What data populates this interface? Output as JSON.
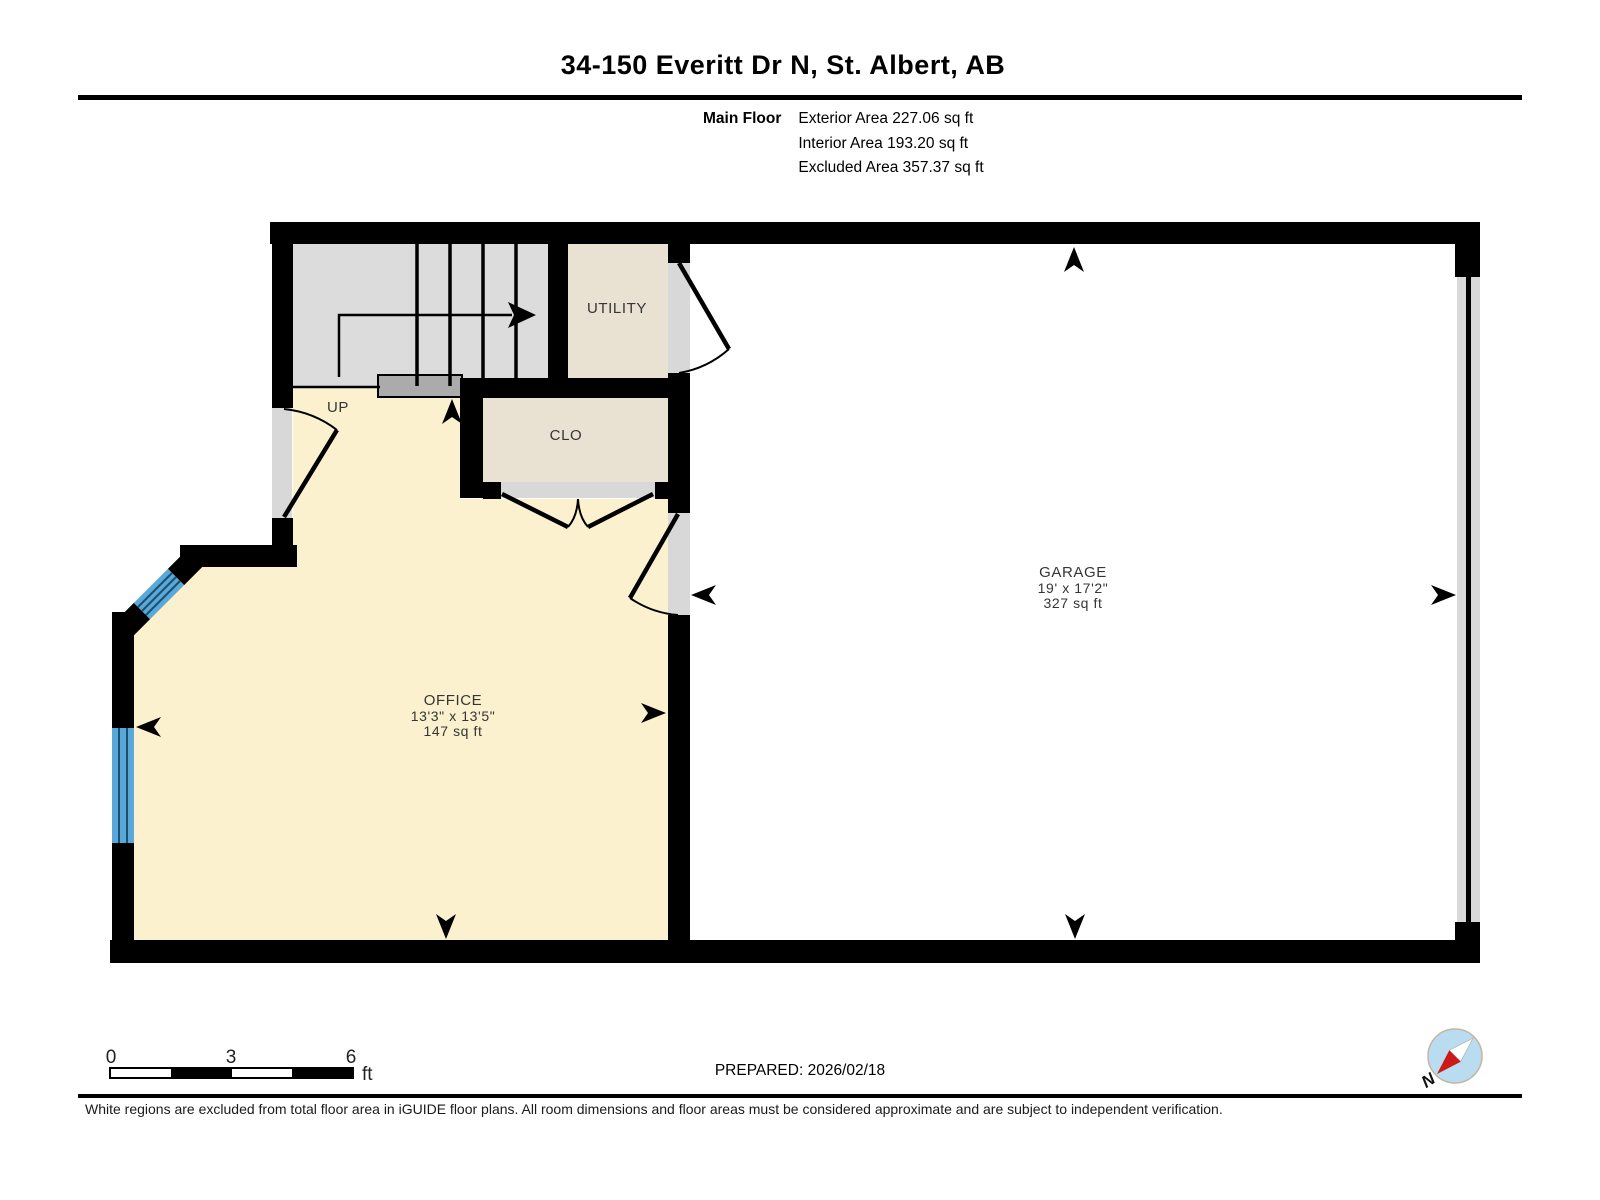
{
  "header": {
    "title": "34-150 Everitt Dr N, St. Albert, AB",
    "floor_label": "Main Floor",
    "exterior_area": "Exterior Area 227.06 sq ft",
    "interior_area": "Interior Area 193.20 sq ft",
    "excluded_area": "Excluded Area 357.37 sq ft"
  },
  "floorplan": {
    "stair_label": "UP",
    "rooms": {
      "utility": {
        "name": "UTILITY"
      },
      "closet": {
        "name": "CLO"
      },
      "office": {
        "name": "OFFICE",
        "dimensions": "13'3\" x 13'5\"",
        "area": "147 sq ft"
      },
      "garage": {
        "name": "GARAGE",
        "dimensions": "19' x 17'2\"",
        "area": "327 sq ft"
      }
    }
  },
  "scale_bar": {
    "ticks": [
      "0",
      "3",
      "6"
    ],
    "unit": "ft"
  },
  "footer": {
    "prepared": "PREPARED: 2026/02/18",
    "compass_label": "N",
    "disclaimer": "White regions are excluded from total floor area in iGUIDE floor plans. All room dimensions and floor areas must be considered approximate and are subject to independent verification."
  },
  "colors": {
    "wall": "#000000",
    "office-floor": "#FBF1CF",
    "tan-floor": "#E9E1D2",
    "stairs-floor": "#DCDCDC",
    "opening": "#D8D8D8",
    "landing": "#ABABAB",
    "window-blue": "#58A9D9",
    "window-line": "#1D4E6E",
    "garage-floor": "#FFFFFF",
    "compass-face": "#B9DCF1",
    "compass-red": "#CC1A1A",
    "label-text": "#353535"
  }
}
